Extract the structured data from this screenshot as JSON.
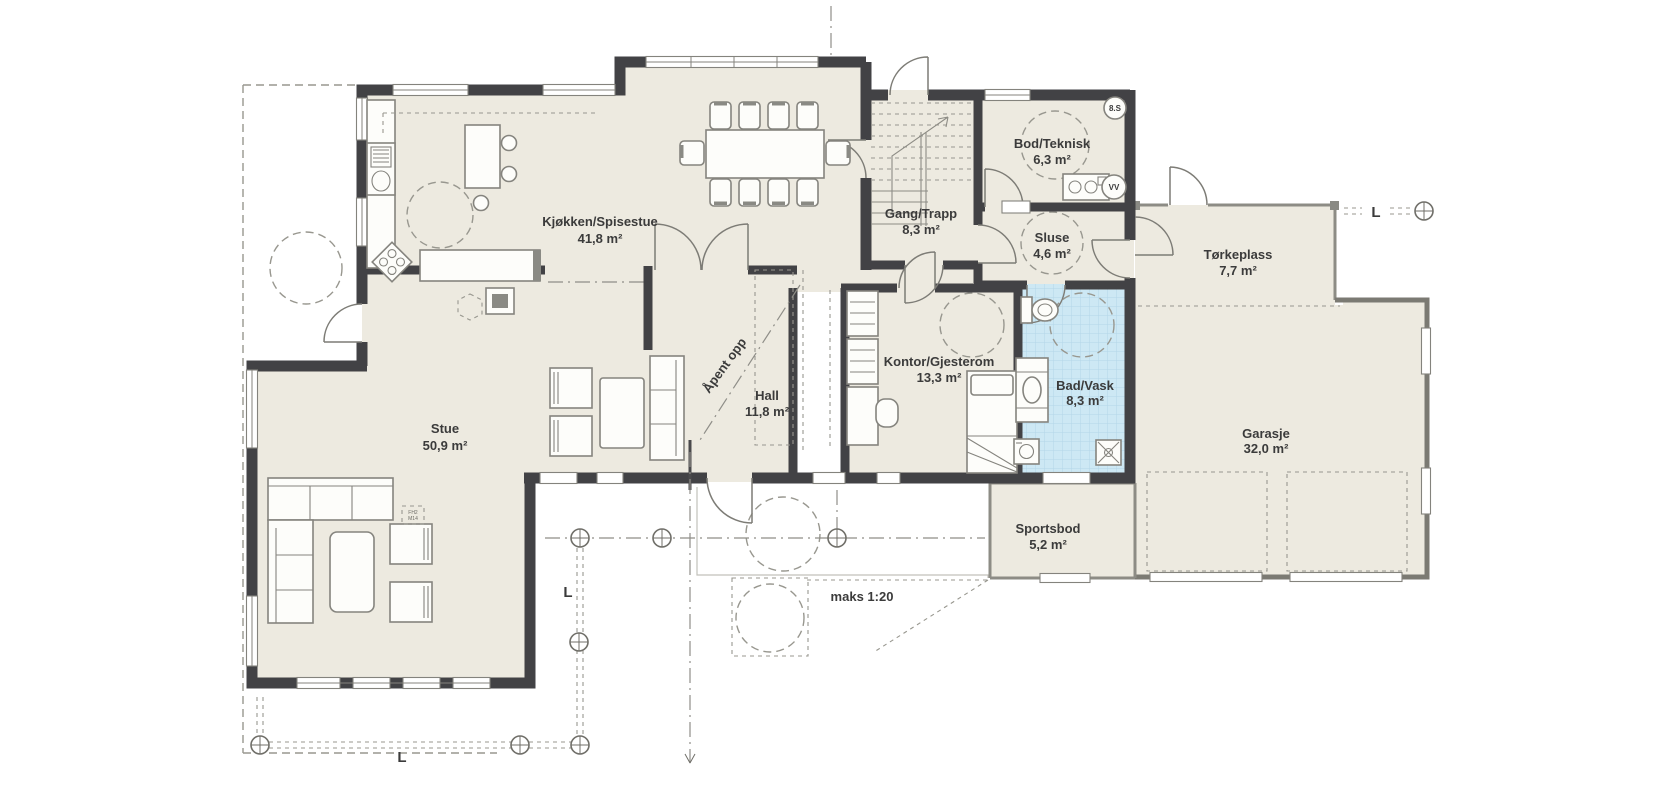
{
  "plan": {
    "rooms": [
      {
        "name": "Kjøkken/Spisestue",
        "area": "41,8 m²"
      },
      {
        "name": "Gang/Trapp",
        "area": "8,3 m²"
      },
      {
        "name": "Bod/Teknisk",
        "area": "6,3 m²"
      },
      {
        "name": "Sluse",
        "area": "4,6 m²"
      },
      {
        "name": "Tørkeplass",
        "area": "7,7 m²"
      },
      {
        "name": "Hall",
        "area": "11,8 m²"
      },
      {
        "name": "Kontor/Gjesterom",
        "area": "13,3 m²"
      },
      {
        "name": "Bad/Vask",
        "area": "8,3 m²"
      },
      {
        "name": "Garasje",
        "area": "32,0 m²"
      },
      {
        "name": "Stue",
        "area": "50,9 m²"
      },
      {
        "name": "Sportsbod",
        "area": "5,2 m²"
      }
    ],
    "annotations": {
      "open_above": "Åpent opp",
      "ramp_slope": "maks 1:20",
      "section_badge": "8.S",
      "axis_label": "L",
      "water_heater": "VV",
      "furniture_code_1": "FH2",
      "furniture_code_2": "M14"
    },
    "colors": {
      "wall": "#424245",
      "floor": "#edeae0",
      "bath_floor": "#cde8f4",
      "bath_tile": "#aed3e5",
      "line": "#85847e",
      "dash": "#98978f",
      "text": "#3b3b3b"
    }
  }
}
